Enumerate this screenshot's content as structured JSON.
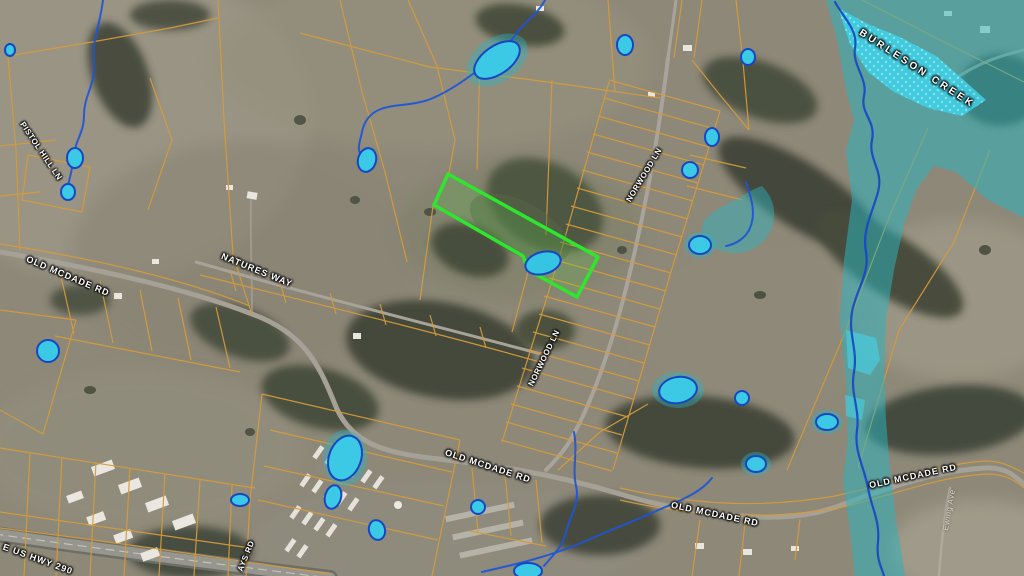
{
  "labels": {
    "pistol_hill_ln": "PISTOL HILL LN",
    "old_mcdade_rd_west": "OLD MCDADE RD",
    "natures_way": "NATURES WAY",
    "norwood_ln_north": "NORWOOD LN",
    "norwood_ln_south": "NORWOOD LN",
    "old_mcdade_rd_center": "OLD MCDADE RD",
    "old_mcdade_rd_east_upper": "OLD MCDADE RD",
    "old_mcdade_rd_east_lower": "OLD MCDADE RD",
    "e_us_hwy_290": "E US HWY 290",
    "burleson_creek": "BURLESON CREEK",
    "ays_rd": "AYS RD",
    "ewing_ave": "Ewing Ave"
  },
  "colors": {
    "parcel_boundary": "#d49b3d",
    "highlighted_parcel": "#2ee62e",
    "floodplain_overlay": "#2fb3bd",
    "floodway_overlay": "#3ed2ea",
    "stream_line": "#1d55d8",
    "pond_fill": "#3cc9e6",
    "pond_outline": "#1747c0",
    "road_label_text": "#ffffff"
  }
}
